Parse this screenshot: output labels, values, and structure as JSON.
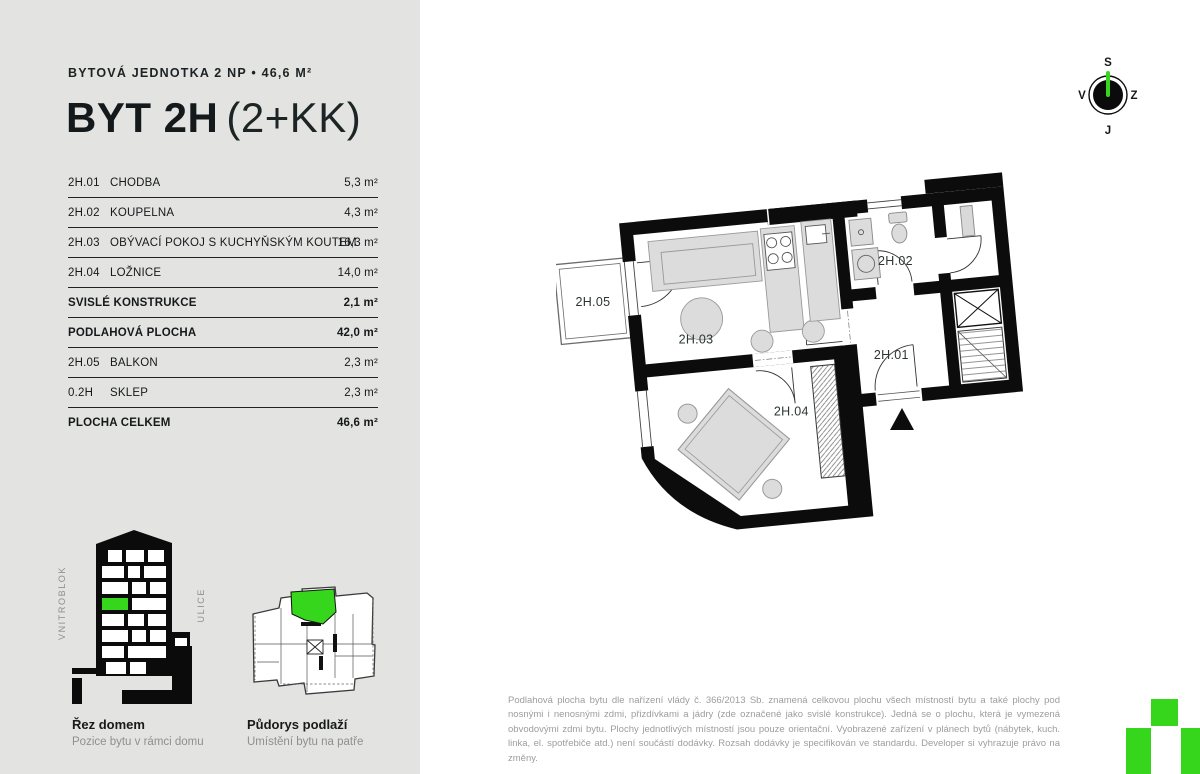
{
  "colors": {
    "accent_green": "#35d61b",
    "panel_bg": "#e3e3e2",
    "wall_black": "#0c0c0c",
    "text_dark": "#16191b",
    "text_gray": "#8f8f8f",
    "disclaimer_gray": "#9d9d9d"
  },
  "header": {
    "subtitle": "BYTOVÁ JEDNOTKA 2 NP • 46,6 M²",
    "title_bold": "BYT 2H",
    "title_light": "(2+KK)"
  },
  "table": {
    "rows": [
      {
        "code": "2H.01",
        "name": "CHODBA",
        "area": "5,3 m²"
      },
      {
        "code": "2H.02",
        "name": "KOUPELNA",
        "area": "4,3 m²"
      },
      {
        "code": "2H.03",
        "name": "OBÝVACÍ POKOJ S KUCHYŇSKÝM KOUTEM",
        "area": "16,3 m²"
      },
      {
        "code": "2H.04",
        "name": "LOŽNICE",
        "area": "14,0 m²"
      },
      {
        "code": "",
        "name": "SVISLÉ KONSTRUKCE",
        "area": "2,1 m²"
      },
      {
        "code": "",
        "name": "PODLAHOVÁ PLOCHA",
        "area": "42,0 m²"
      },
      {
        "code": "2H.05",
        "name": "BALKON",
        "area": "2,3 m²"
      },
      {
        "code": "0.2H",
        "name": "SKLEP",
        "area": "2,3 m²"
      },
      {
        "code": "",
        "name": "PLOCHA CELKEM",
        "area": "46,6 m²"
      }
    ]
  },
  "diagrams": {
    "section": {
      "title": "Řez domem",
      "subtitle": "Pozice bytu v rámci domu",
      "label_left": "VNITROBLOK",
      "label_right": "ULICE"
    },
    "floor": {
      "title": "Půdorys podlaží",
      "subtitle": "Umístění bytu na patře"
    }
  },
  "compass": {
    "top": "S",
    "right": "Z",
    "bottom": "J",
    "left": "V"
  },
  "plan": {
    "labels": {
      "r01": "2H.01",
      "r02": "2H.02",
      "r03": "2H.03",
      "r04": "2H.04",
      "r05": "2H.05"
    }
  },
  "disclaimer": "Podlahová plocha bytu dle nařízení vlády č. 366/2013 Sb. znamená celkovou plochu všech místností bytu a také plochy pod nosnými i nenosnými zdmi, přizdívkami a jádry (zde označené jako svislé konstrukce). Jedná se o plochu, která je vymezená obvodovými zdmi bytu. Plochy jednotlivých místností jsou pouze orientační. Vyobrazené zařízení v plánech bytů (nábytek, kuch. linka, el. spotřebiče atd.) není součástí dodávky. Rozsah dodávky je specifikován ve standardu. Developer si vyhrazuje právo na změny."
}
